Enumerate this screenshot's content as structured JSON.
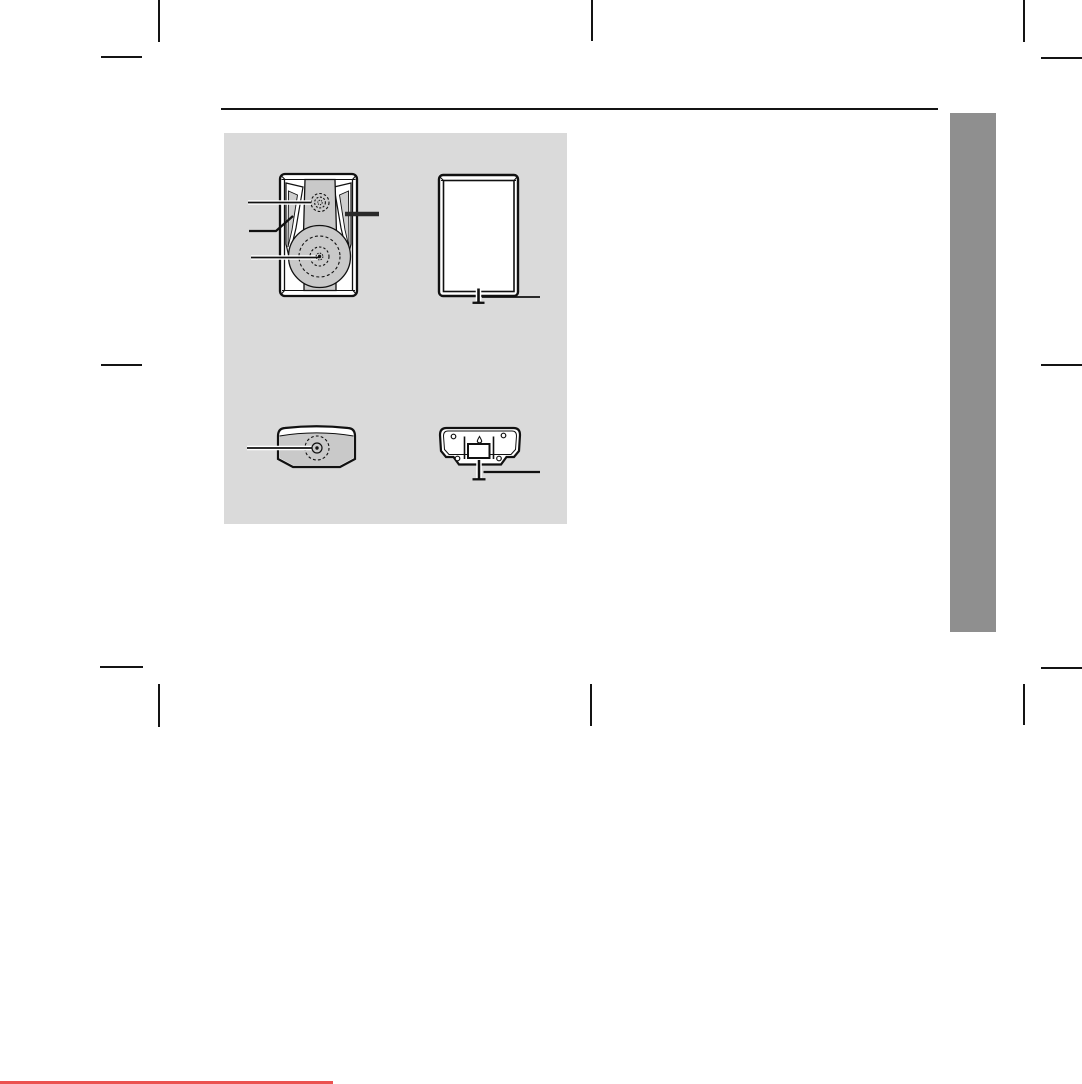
{
  "document": {
    "kind": "scanned-speaker-manual-page",
    "visible_text": "",
    "illustration_count": 4
  },
  "colors": {
    "page_background": "#ffffff",
    "ink": "#141414",
    "illustration_panel": "#dadada",
    "illustration_fill": "#c9c9c9",
    "side_tab": "#8f8f8f",
    "bottom_edge_line": "#eb5250"
  },
  "figures": {
    "front_view": {
      "name": "speaker-front-view",
      "drivers": [
        "tweeter",
        "woofer"
      ],
      "callout_count": 4
    },
    "rear_view": {
      "name": "speaker-rear-view",
      "features": [
        "power-cord"
      ],
      "callout_count": 1
    },
    "top_view": {
      "name": "speaker-top-view",
      "drivers": [
        "top-driver"
      ],
      "callout_count": 1
    },
    "bottom_view": {
      "name": "speaker-bottom-view",
      "features": [
        "screw-holes",
        "keyhole-slot",
        "label-plate",
        "power-cord"
      ],
      "callout_count": 1
    }
  }
}
